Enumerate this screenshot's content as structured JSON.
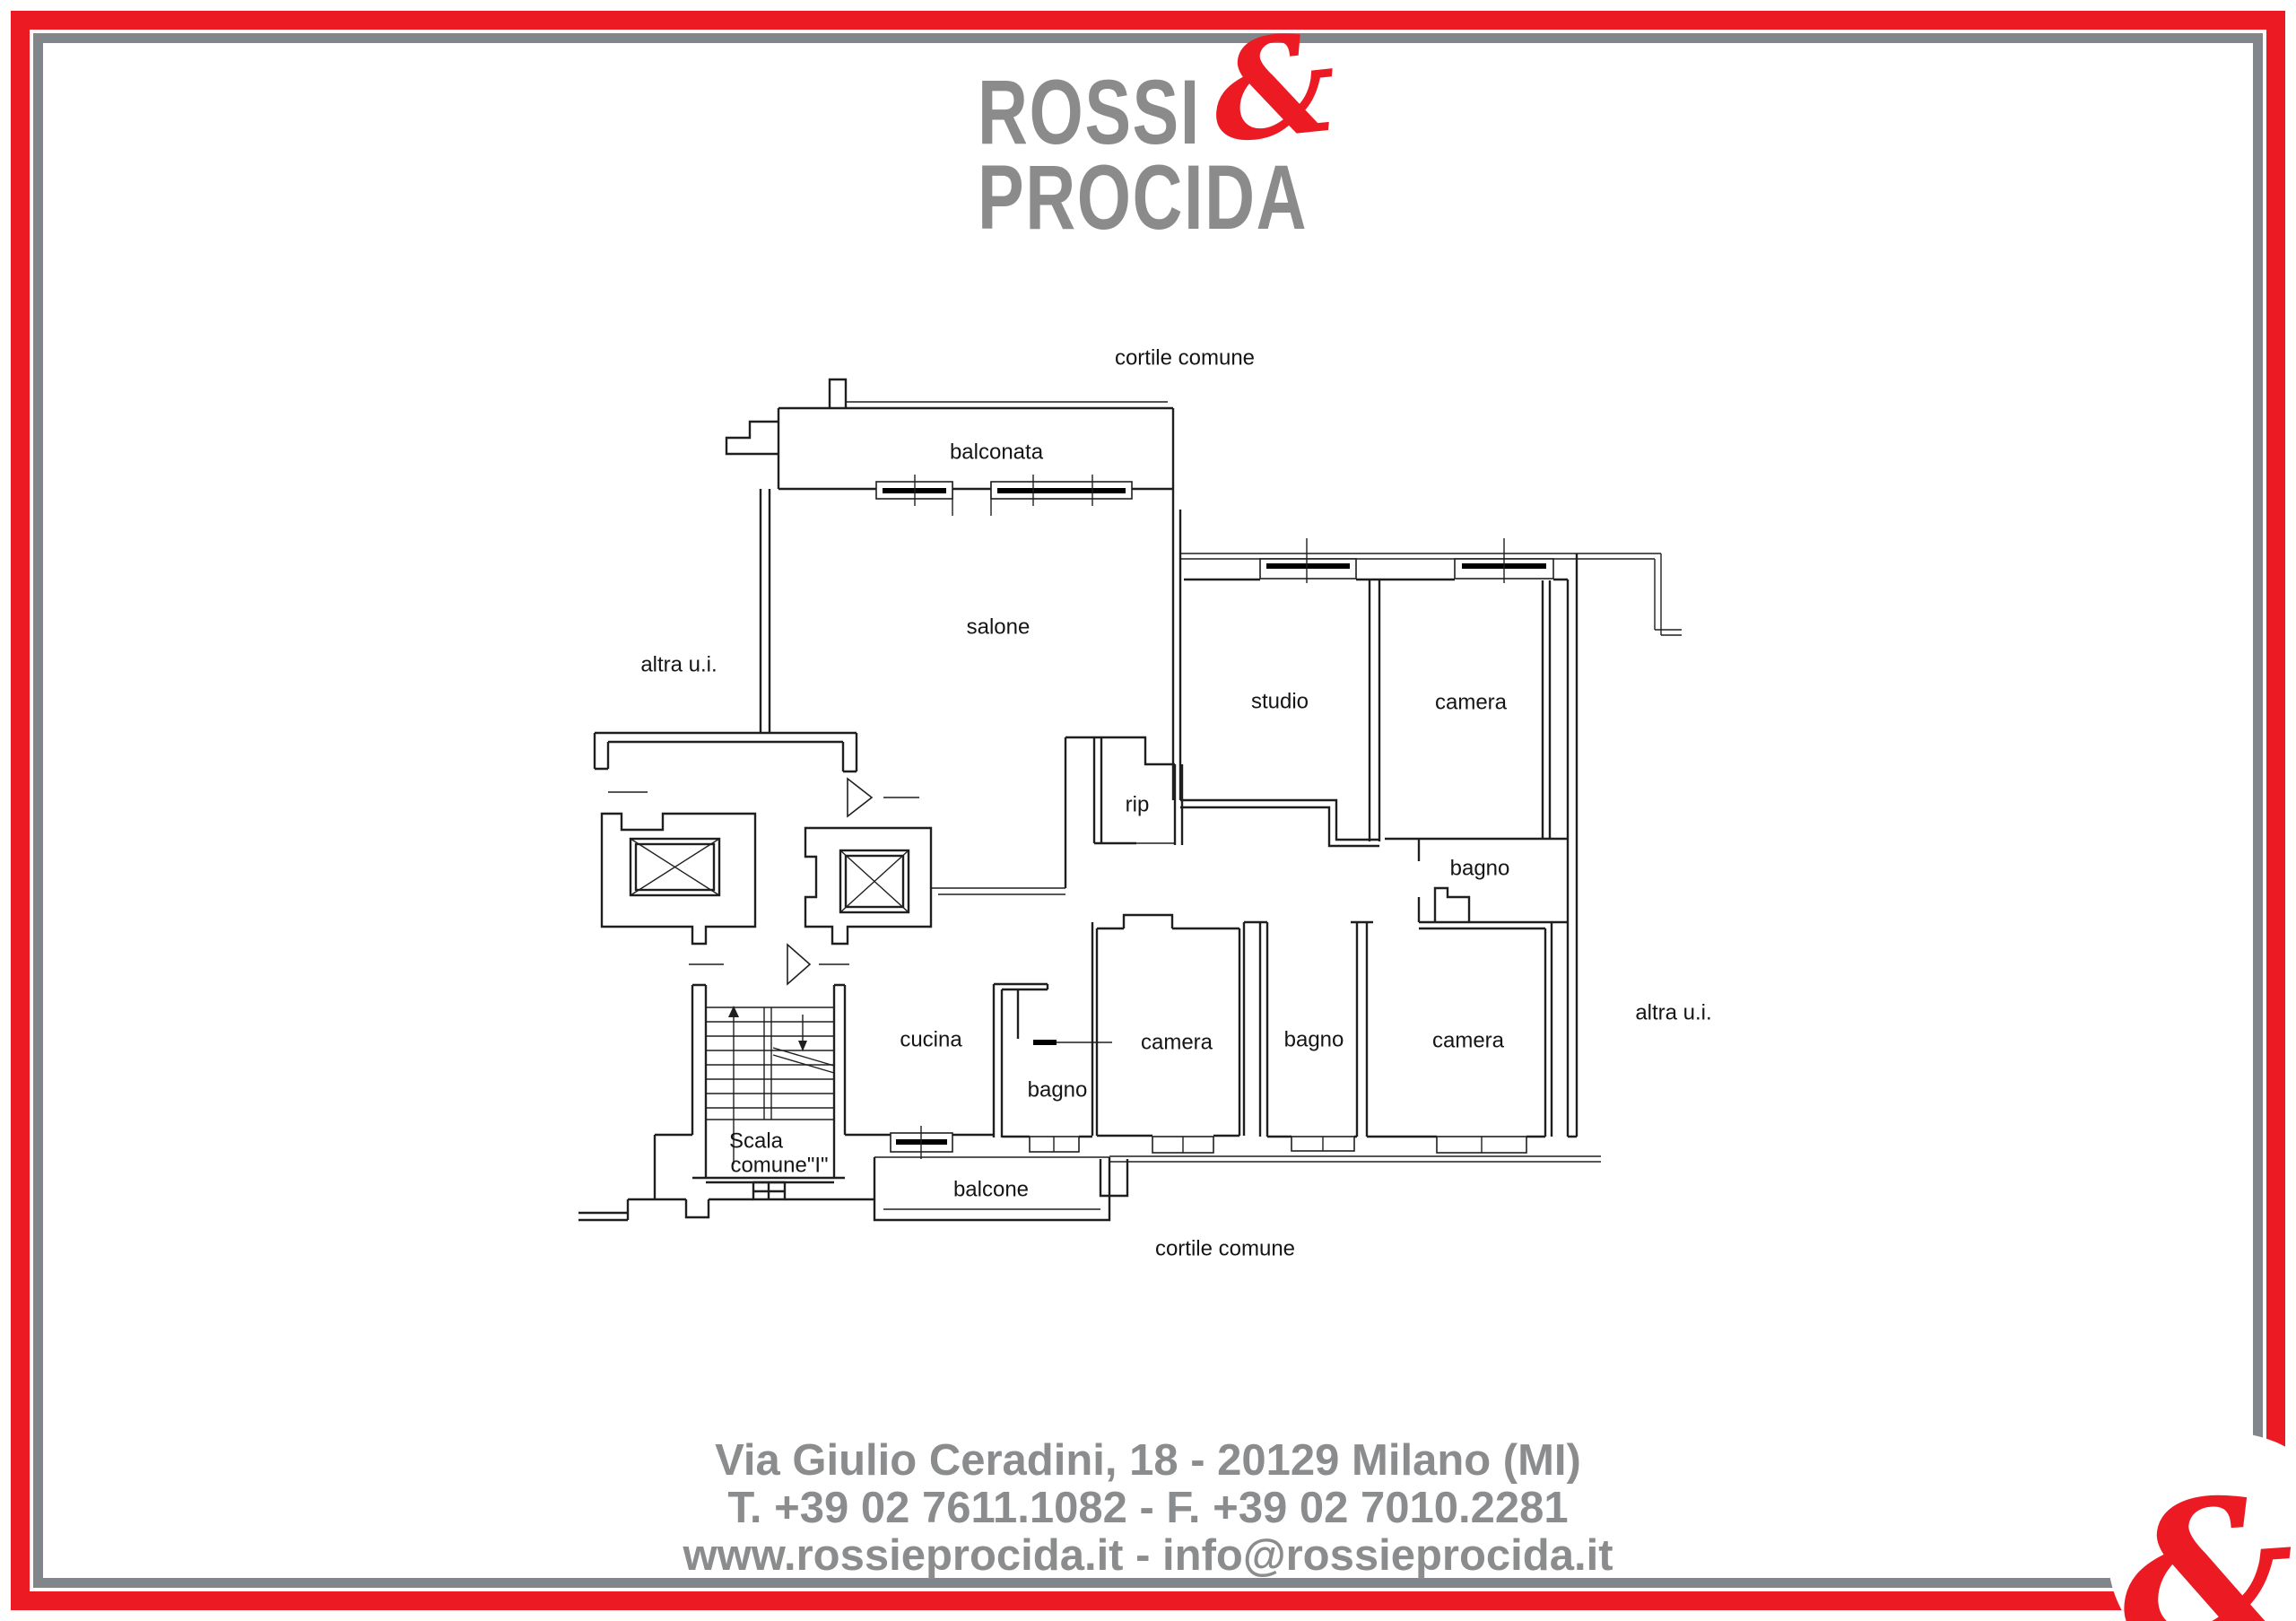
{
  "colors": {
    "accent_red": "#ec1b23",
    "border_gray": "#828589",
    "logo_gray": "#8b8b8b",
    "footer_gray": "#8a8c8e",
    "plan_line": "#1f1f1f"
  },
  "logo": {
    "name_line1": "ROSSI",
    "name_line2": "PROCIDA",
    "ampersand": "&"
  },
  "floor_plan": {
    "labels": [
      {
        "id": "cortile-top",
        "text": "cortile comune"
      },
      {
        "id": "balconata",
        "text": "balconata"
      },
      {
        "id": "salone",
        "text": "salone"
      },
      {
        "id": "altra-ui-left",
        "text": "altra u.i."
      },
      {
        "id": "studio",
        "text": "studio"
      },
      {
        "id": "camera-top",
        "text": "camera"
      },
      {
        "id": "rip",
        "text": "rip"
      },
      {
        "id": "bagno-top",
        "text": "bagno"
      },
      {
        "id": "cucina",
        "text": "cucina"
      },
      {
        "id": "camera-mid",
        "text": "camera"
      },
      {
        "id": "bagno-mid",
        "text": "bagno"
      },
      {
        "id": "camera-right",
        "text": "camera"
      },
      {
        "id": "altra-ui-right",
        "text": "altra u.i."
      },
      {
        "id": "bagno-small",
        "text": "bagno"
      },
      {
        "id": "scala-line1",
        "text": "Scala"
      },
      {
        "id": "scala-line2",
        "text": "comune\"I\""
      },
      {
        "id": "balcone",
        "text": "balcone"
      },
      {
        "id": "cortile-bottom",
        "text": "cortile comune"
      }
    ]
  },
  "footer": {
    "address": "Via Giulio Ceradini, 18 - 20129 Milano (MI)",
    "phones": "T. +39 02 7611.1082 - F. +39 02 7010.2281",
    "web": "www.rossieprocida.it - info@rossieprocida.it"
  },
  "corner_badge": {
    "ampersand": "&"
  }
}
